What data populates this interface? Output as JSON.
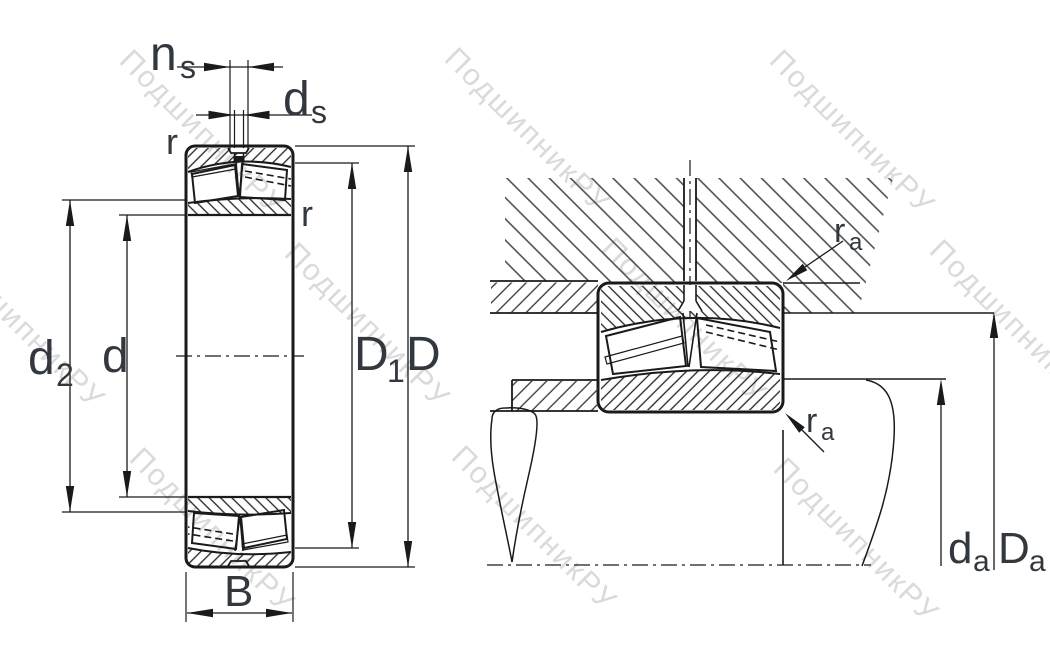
{
  "title": "spherical-roller-bearing-dimension-drawing",
  "colors": {
    "line": "#1a1a1a",
    "label": "#32383e",
    "watermark": "#c2c2c2",
    "background": "#ffffff"
  },
  "watermark": {
    "text": "ПодшипникРУ",
    "positions": [
      {
        "x": 118,
        "y": 62
      },
      {
        "x": 443,
        "y": 60
      },
      {
        "x": 768,
        "y": 62
      },
      {
        "x": -62,
        "y": 256
      },
      {
        "x": 283,
        "y": 255
      },
      {
        "x": 600,
        "y": 250
      },
      {
        "x": 928,
        "y": 252
      },
      {
        "x": 128,
        "y": 460
      },
      {
        "x": 450,
        "y": 458
      },
      {
        "x": 772,
        "y": 470
      }
    ]
  },
  "front_view": {
    "labels": {
      "ns": {
        "main": "n",
        "sub": "s"
      },
      "ds": {
        "main": "d",
        "sub": "s"
      },
      "r_top": "r",
      "r_side": "r",
      "d2": {
        "main": "d",
        "sub": "2"
      },
      "d": "d",
      "D1": {
        "main": "D",
        "sub": "1"
      },
      "D": "D",
      "B": "B"
    }
  },
  "mounted_view": {
    "labels": {
      "ra_top": {
        "main": "r",
        "sub": "a"
      },
      "ra_bottom": {
        "main": "r",
        "sub": "a"
      },
      "da": {
        "main": "d",
        "sub": "a"
      },
      "Da": {
        "main": "D",
        "sub": "a"
      }
    }
  }
}
